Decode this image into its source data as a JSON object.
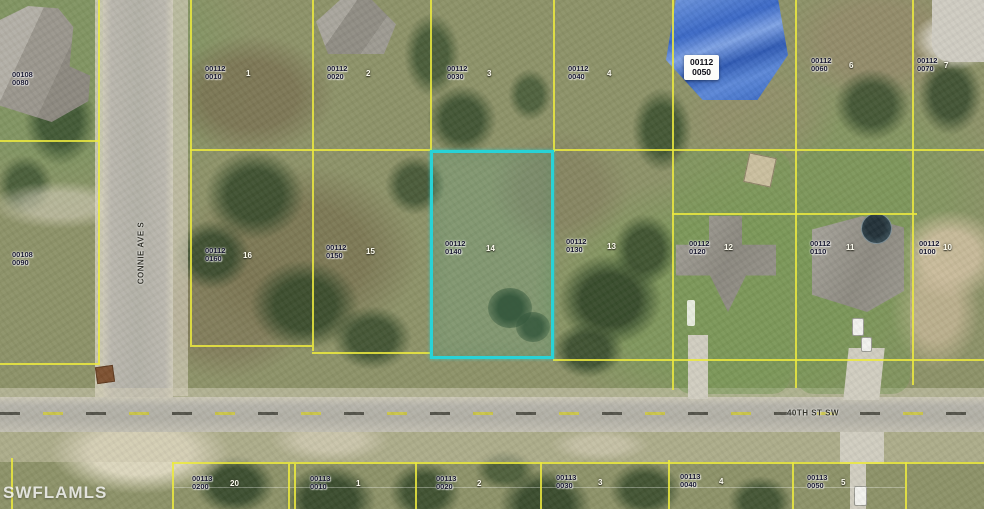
{
  "watermark": "SWFLAMLS",
  "streets": {
    "vertical": {
      "name": "CONNIE AVE S"
    },
    "horizontal": {
      "name": "40TH ST SW"
    }
  },
  "highlight": {
    "parcel": "00112 0140",
    "lot_number": "14",
    "outline_color": "#28d3d7"
  },
  "colors": {
    "parcel_line": "#ecea3e",
    "label_text": "#16162e",
    "lot_number_text": "#ffffff",
    "blue_roof": "#3a68c6"
  },
  "parcel_labels": [
    {
      "line1": "00108",
      "line2": "0080",
      "x": 12,
      "y": 71
    },
    {
      "line1": "00112",
      "line2": "0010",
      "x": 205,
      "y": 65,
      "num": "1",
      "nx": 246,
      "ny": 69
    },
    {
      "line1": "00112",
      "line2": "0020",
      "x": 327,
      "y": 65,
      "num": "2",
      "nx": 366,
      "ny": 69
    },
    {
      "line1": "00112",
      "line2": "0030",
      "x": 447,
      "y": 65,
      "num": "3",
      "nx": 487,
      "ny": 69
    },
    {
      "line1": "00112",
      "line2": "0040",
      "x": 568,
      "y": 65,
      "num": "4",
      "nx": 607,
      "ny": 69
    },
    {
      "line1": "00112",
      "line2": "0050",
      "x": 684,
      "y": 55,
      "style": "box"
    },
    {
      "line1": "00112",
      "line2": "0060",
      "x": 811,
      "y": 57,
      "num": "6",
      "nx": 849,
      "ny": 61
    },
    {
      "line1": "00112",
      "line2": "0070",
      "x": 917,
      "y": 57,
      "num": "7",
      "nx": 944,
      "ny": 61
    },
    {
      "line1": "00108",
      "line2": "0090",
      "x": 12,
      "y": 251
    },
    {
      "line1": "00112",
      "line2": "0160",
      "x": 205,
      "y": 247,
      "num": "16",
      "nx": 243,
      "ny": 251
    },
    {
      "line1": "00112",
      "line2": "0150",
      "x": 326,
      "y": 244,
      "num": "15",
      "nx": 366,
      "ny": 247
    },
    {
      "line1": "00112",
      "line2": "0140",
      "x": 445,
      "y": 240,
      "num": "14",
      "nx": 486,
      "ny": 244
    },
    {
      "line1": "00112",
      "line2": "0130",
      "x": 566,
      "y": 238,
      "num": "13",
      "nx": 607,
      "ny": 242
    },
    {
      "line1": "00112",
      "line2": "0120",
      "x": 689,
      "y": 240,
      "num": "12",
      "nx": 724,
      "ny": 243
    },
    {
      "line1": "00112",
      "line2": "0110",
      "x": 810,
      "y": 240,
      "num": "11",
      "nx": 846,
      "ny": 243
    },
    {
      "line1": "00112",
      "line2": "0100",
      "x": 919,
      "y": 240,
      "num": "10",
      "nx": 943,
      "ny": 243
    },
    {
      "line1": "00113",
      "line2": "0200",
      "x": 192,
      "y": 475,
      "num": "20",
      "nx": 230,
      "ny": 479
    },
    {
      "line1": "00113",
      "line2": "0010",
      "x": 310,
      "y": 475,
      "num": "1",
      "nx": 356,
      "ny": 479
    },
    {
      "line1": "00113",
      "line2": "0020",
      "x": 436,
      "y": 475,
      "num": "2",
      "nx": 477,
      "ny": 479
    },
    {
      "line1": "00113",
      "line2": "0030",
      "x": 556,
      "y": 474,
      "num": "3",
      "nx": 598,
      "ny": 478
    },
    {
      "line1": "00113",
      "line2": "0040",
      "x": 680,
      "y": 473,
      "num": "4",
      "nx": 719,
      "ny": 477
    },
    {
      "line1": "00113",
      "line2": "0050",
      "x": 807,
      "y": 474,
      "num": "5",
      "nx": 841,
      "ny": 478
    }
  ]
}
